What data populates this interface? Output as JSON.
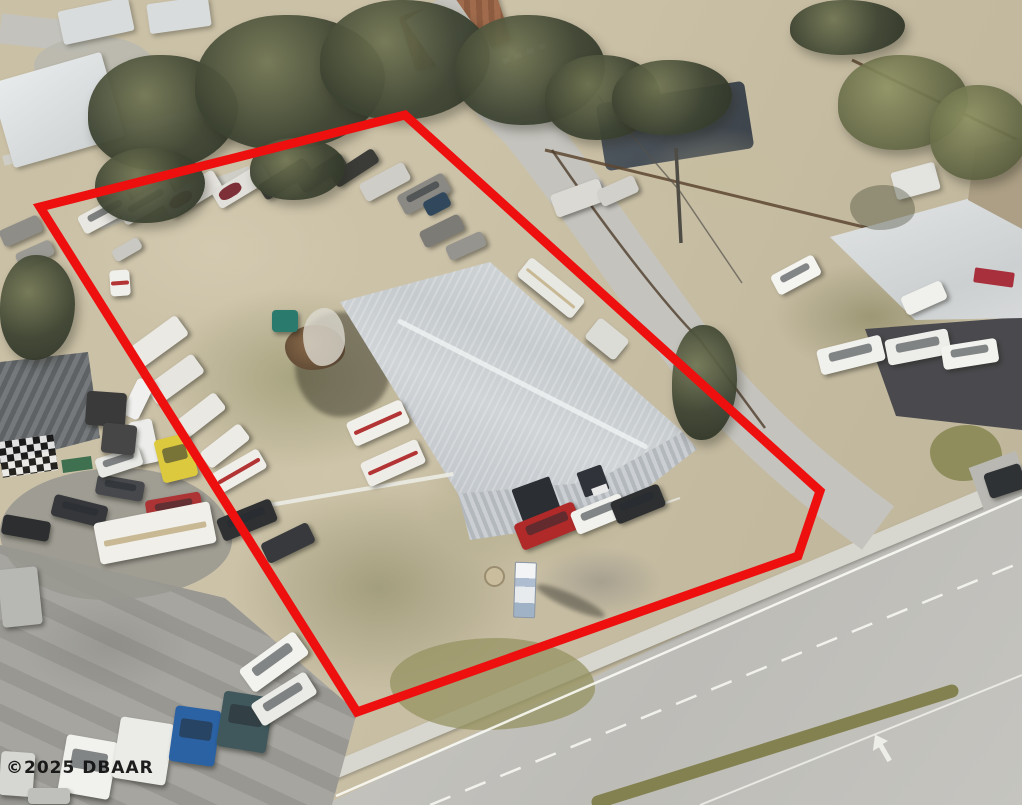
{
  "watermark": {
    "text": "©2025 DBAAR"
  },
  "annotation": {
    "boundary_color": "#ee0f0f",
    "boundary_points": "405,115 40,207 357,712 798,556 820,491",
    "boundary_stroke_width": "9"
  }
}
